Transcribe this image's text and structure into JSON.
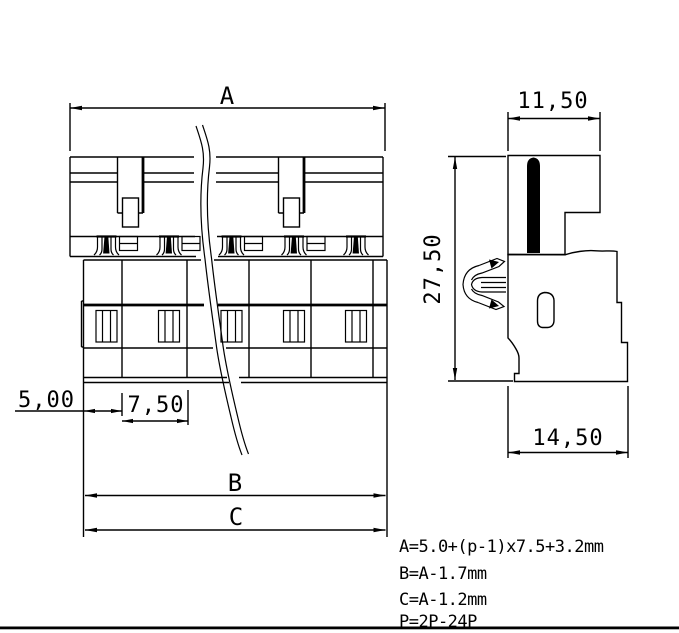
{
  "colors": {
    "line": "#000000",
    "background": "#ffffff"
  },
  "front_view": {
    "dim_a": "A",
    "dim_b": "B",
    "dim_c": "C",
    "dim_edge": "5,00",
    "dim_pitch": "7,50"
  },
  "side_view": {
    "dim_top_width": "11,50",
    "dim_height": "27,50",
    "dim_bottom_width": "14,50"
  },
  "notes": {
    "formula_a": "A=5.0+(p-1)x7.5+3.2mm",
    "formula_b": "B=A-1.7mm",
    "formula_c": "C=A-1.2mm",
    "formula_p": "P=2P-24P"
  }
}
